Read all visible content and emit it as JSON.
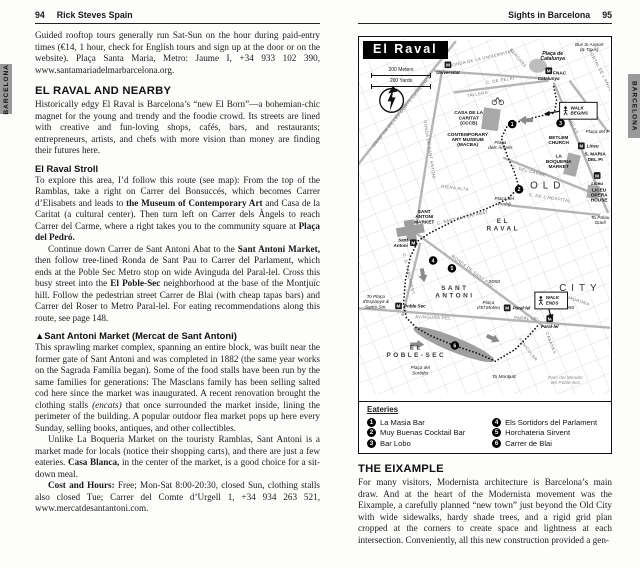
{
  "tabs": {
    "left": "BARCELONA",
    "right": "BARCELONA"
  },
  "left_page": {
    "page_number": "94",
    "header_title": "Rick Steves Spain",
    "intro": "Guided rooftop tours generally run Sat-Sun on the hour during paid-entry times (€14, 1 hour, check for English tours and sign up at the door or on the website). Plaça Santa Maria, Metro: Jaume I, +34 933 102 390, www.santamariadelmarbarcelona.org.",
    "raval_heading": "EL RAVAL AND NEARBY",
    "raval_intro": "Historically edgy El Raval is Barcelona’s “new El Born”—a bohemian-chic magnet for the young and trendy and the foodie crowd. Its streets are lined with creative and fun-loving shops, cafés, bars, and restaurants; entrepreneurs, artists, and chefs with more vision than money are finding their futures here.",
    "stroll_heading": "El Raval Stroll",
    "stroll_p1": [
      {
        "t": "To explore this area, I’d follow this route (see map): From the top of the Ramblas, take a right on Carrer del Bonsuccés, which becomes Carrer d’Elisabets and leads to "
      },
      {
        "t": "the Museum of Contemporary Art",
        "b": true
      },
      {
        "t": " and Casa de la Caritat (a cultural center). Then turn left on Carrer dels Àngels to reach Carrer del Carme, where a right takes you to the community square at "
      },
      {
        "t": "Plaça del Pedró.",
        "b": true
      }
    ],
    "stroll_p2": [
      {
        "t": "Continue down Carrer de Sant Antoni Abat to the "
      },
      {
        "t": "Sant Antoni Market,",
        "b": true
      },
      {
        "t": " then follow tree-lined Ronda de Sant Pau to Carrer del Parlament, which ends at the Poble Sec Metro stop on wide Avinguda del Paral-lel. Cross this busy street into the "
      },
      {
        "t": "El Poble-Sec",
        "b": true
      },
      {
        "t": " neighborhood at the base of the Montjuïc hill. Follow the pedestrian street Carrer de Blai (with cheap tapas bars) and Carrer del Roser to Metro Paral-lel. For eating recommendations along this route, see page 148."
      }
    ],
    "market_heading": "▲Sant Antoni Market (Mercat de Sant Antoni)",
    "market_p1": [
      {
        "t": "This sprawling market complex, spanning an entire block, was built near the former gate of Sant Antoni and was completed in 1882 (the same year works on the Sagrada Família began). Some of the food stalls have been run by the same families for generations: The Masclans family has been selling salted cod here since the market was inaugurated. A recent renovation brought the clothing stalls "
      },
      {
        "t": "(encats)",
        "i": true
      },
      {
        "t": " that once surrounded the market inside, lining the perimeter of the building. A popular outdoor flea market pops up here every Sunday, selling books, antiques, and other collectibles."
      }
    ],
    "market_p2": [
      {
        "t": "Unlike La Boqueria Market on the touristy Ramblas, Sant Antoni is a market made for locals (notice their shopping carts), and there are just a few eateries. "
      },
      {
        "t": "Casa Blanca,",
        "b": true
      },
      {
        "t": " in the center of the market, is a good choice for a sit-down meal."
      }
    ],
    "market_p3": [
      {
        "t": "Cost and Hours: ",
        "b": true
      },
      {
        "t": "Free; Mon-Sat 8:00-20:30, closed Sun, clothing stalls also closed Tue; Carrer del Comte d’Urgell 1, +34 934 263 521, www.mercatdesantantoni.com."
      }
    ]
  },
  "right_page": {
    "header_title": "Sights in Barcelona",
    "page_number": "95",
    "map": {
      "title": "El Raval",
      "scale_meters": "200 Meters",
      "scale_yards": "200 Yards",
      "icons": [
        "north-compass-icon",
        "metro-station-icon",
        "pedestrian-walker-icon",
        "bicycle-icon",
        "route-direction-arrow-icon"
      ],
      "labels": [
        {
          "t": "GRAN VIA DE LES CORTS CATALANES",
          "x": 44,
          "y": 74,
          "r": -51,
          "c": "st"
        },
        {
          "t": "RONDA DE LA UNIVERSITAT",
          "x": 124,
          "y": 21,
          "r": -13,
          "c": "st"
        },
        {
          "t": "C. DE PELAI",
          "x": 143,
          "y": 43,
          "r": -9,
          "c": "st"
        },
        {
          "t": "TALLERS",
          "x": 120,
          "y": 57,
          "r": -9,
          "c": "st"
        },
        {
          "t": "BERGARA",
          "x": 160,
          "y": 20,
          "r": 50,
          "c": "st"
        },
        {
          "t": "RONDA DE SANT ANTONI",
          "x": 70,
          "y": 112,
          "r": 81,
          "c": "st"
        },
        {
          "t": "RONDA DE SANT PAU",
          "x": 114,
          "y": 236,
          "r": 37,
          "c": "st"
        },
        {
          "t": "AVINGUDA DEL",
          "x": 75,
          "y": 283,
          "r": 2,
          "c": "st"
        },
        {
          "t": "PARAL·LEL",
          "x": 170,
          "y": 284,
          "r": 3,
          "c": "st"
        },
        {
          "t": "RAMBLAS",
          "x": 214,
          "y": 86,
          "r": 64,
          "c": "st"
        },
        {
          "t": "PORTAL DE L'ANGEL",
          "x": 244,
          "y": 34,
          "r": 62,
          "c": "st"
        },
        {
          "t": "C. DEL CARME",
          "x": 172,
          "y": 135,
          "r": 14,
          "c": "st"
        },
        {
          "t": "C. DE L'HOSPITAL",
          "x": 193,
          "y": 162,
          "r": 9,
          "c": "st"
        },
        {
          "t": "RIERA ALTA",
          "x": 97,
          "y": 152,
          "r": 7,
          "c": "st"
        },
        {
          "t": "C. SANT ANTONI ABAT",
          "x": 105,
          "y": 182,
          "r": -13,
          "c": "st"
        },
        {
          "t": "C. D. PARLAMENT",
          "x": 49,
          "y": 238,
          "r": 77,
          "c": "st"
        },
        {
          "t": "FUNICULAR",
          "x": 170,
          "y": 315,
          "r": 52,
          "c": "st"
        },
        {
          "t": "S. MADRONA",
          "x": 218,
          "y": 265,
          "r": 18,
          "c": "st"
        },
        {
          "t": "CABANES",
          "x": 193,
          "y": 308,
          "r": 68,
          "c": "st"
        },
        {
          "t": "FNAC",
          "x": 203,
          "y": 36,
          "c": "poi"
        },
        {
          "t": "CASA DE LA\nCARITAT\n(CCCB)",
          "x": 111,
          "y": 76,
          "c": "poi"
        },
        {
          "t": "CONTEMPORARY\nART MUSEUM\n(MACBA)",
          "x": 110,
          "y": 98,
          "c": "poi"
        },
        {
          "t": "BETLEM\nCHURCH",
          "x": 202,
          "y": 101,
          "c": "poi"
        },
        {
          "t": "LA\nBOQUERIA\nMARKET",
          "x": 202,
          "y": 120,
          "c": "poi"
        },
        {
          "t": "S. MARIA\nDEL PI",
          "x": 239,
          "y": 118,
          "c": "poi"
        },
        {
          "t": "LICEU\nOPERA\nHOUSE",
          "x": 243,
          "y": 154,
          "c": "poi"
        },
        {
          "t": "SANT\nANTONI\nMARKET",
          "x": 66,
          "y": 176,
          "c": "poi"
        },
        {
          "t": "Bus to Airport\n(& Taxis)",
          "x": 233,
          "y": 7,
          "c": "it"
        },
        {
          "t": "Plaça de\nCatalunya",
          "x": 196,
          "y": 16,
          "c": "itb"
        },
        {
          "t": "Plaça\ndels Àngels",
          "x": 143,
          "y": 106,
          "c": "it"
        },
        {
          "t": "Plaça del\nPedró",
          "x": 147,
          "y": 163,
          "c": "it"
        },
        {
          "t": "Plaça del Pi",
          "x": 242,
          "y": 95,
          "c": "it"
        },
        {
          "t": "To Palau\nGüell",
          "x": 244,
          "y": 182,
          "c": "it"
        },
        {
          "t": "To Plaça\nd'Espanya &\nSants Stn.",
          "x": 17,
          "y": 262,
          "c": "it"
        },
        {
          "t": "Plaça\nd'El Molino",
          "x": 131,
          "y": 268,
          "c": "it"
        },
        {
          "t": "Plaça del\nSortidor",
          "x": 62,
          "y": 334,
          "c": "it"
        },
        {
          "t": "To Montjuïc",
          "x": 147,
          "y": 343,
          "c": "it"
        },
        {
          "t": "Parc del Mirador\ndel Poble-Sec",
          "x": 209,
          "y": 344,
          "c": "itg"
        },
        {
          "t": "#D50",
          "x": 137,
          "y": 247,
          "c": "it"
        },
        {
          "t": "#D50",
          "x": 212,
          "y": 273,
          "c": "it"
        },
        {
          "t": "EL\nRAVAL",
          "x": 146,
          "y": 186,
          "c": "area"
        },
        {
          "t": "SANT\nANTONI",
          "x": 97,
          "y": 254,
          "c": "area"
        },
        {
          "t": "EL\nPOBLE-SEC",
          "x": 58,
          "y": 314,
          "c": "area"
        },
        {
          "t": "OLD",
          "x": 191,
          "y": 151,
          "c": "areaXL"
        },
        {
          "t": "CITY",
          "x": 224,
          "y": 255,
          "c": "areaXL"
        }
      ],
      "metro_stations": [
        {
          "x": 90,
          "y": 26,
          "label": "Universitat",
          "lp": "below"
        },
        {
          "x": 192,
          "y": 32,
          "label": "Catalunya",
          "lp": "below"
        },
        {
          "x": 225,
          "y": 108,
          "label": "Liceu",
          "lp": "right"
        },
        {
          "x": 241,
          "y": 138,
          "label": "Liceu",
          "lp": "below"
        },
        {
          "x": 55,
          "y": 206,
          "label": "Sant\nAntoni",
          "lp": "left"
        },
        {
          "x": 40,
          "y": 270,
          "label": "Poble Sec",
          "lp": "right"
        },
        {
          "x": 150,
          "y": 272,
          "label": "Paral·lel",
          "lp": "right"
        },
        {
          "x": 193,
          "y": 283,
          "label": "Paral·lel",
          "lp": "below"
        }
      ],
      "markers": [
        {
          "n": "1",
          "x": 155,
          "y": 86
        },
        {
          "n": "2",
          "x": 162,
          "y": 152
        },
        {
          "n": "3",
          "x": 204,
          "y": 85
        },
        {
          "n": "4",
          "x": 75,
          "y": 224
        },
        {
          "n": "5",
          "x": 94,
          "y": 232
        },
        {
          "n": "6",
          "x": 97,
          "y": 310
        }
      ],
      "walk_boxes": [
        {
          "t": "WALK\nBEGINS",
          "x": 203,
          "y": 64,
          "w": 38,
          "h": 17
        },
        {
          "t": "WALK\nENDS",
          "x": 178,
          "y": 256,
          "w": 33,
          "h": 17
        }
      ],
      "legend": {
        "title": "Eateries",
        "items": [
          {
            "n": "1",
            "label": "La Masia Bar"
          },
          {
            "n": "2",
            "label": "Muy Buenas Cocktail Bar"
          },
          {
            "n": "3",
            "label": "Bar Lobo"
          },
          {
            "n": "4",
            "label": "Els Sortidors del Parlament"
          },
          {
            "n": "5",
            "label": "Horchateria Sirvent"
          },
          {
            "n": "6",
            "label": "Carrer de Blai"
          }
        ]
      }
    },
    "eixample_heading": "THE EIXAMPLE",
    "eixample_p": "For many visitors, Modernista architecture is Barcelona’s main draw. And at the heart of the Modernista movement was the Eixample, a carefully planned “new town” just beyond the Old City with wide sidewalks, hardy shade trees, and a rigid grid plan cropped at the corners to create space and lightness at each intersection. Conveniently, all this new construction provided a gen-"
  }
}
